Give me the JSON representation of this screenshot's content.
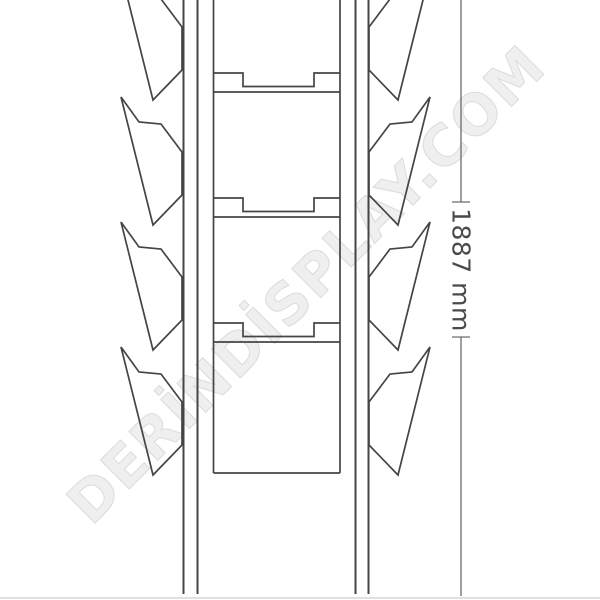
{
  "drawing": {
    "type": "technical-line-drawing",
    "subject": "brochure display stand side-profile with stacked literature pockets",
    "pockets_per_side": 4,
    "shelf_dividers": 3
  },
  "dimension": {
    "label": "1887 mm",
    "value": 1887,
    "unit": "mm"
  },
  "watermark": {
    "text": "DERİNDİSPLAY.COM"
  },
  "colors": {
    "line": "#454545",
    "dimension_line": "#6a6a6a",
    "text": "#4a4a4a",
    "watermark_fill": "#efefef",
    "watermark_outline": "#dbdbdb",
    "ground": "#d5d5d5",
    "background": "#ffffff"
  }
}
